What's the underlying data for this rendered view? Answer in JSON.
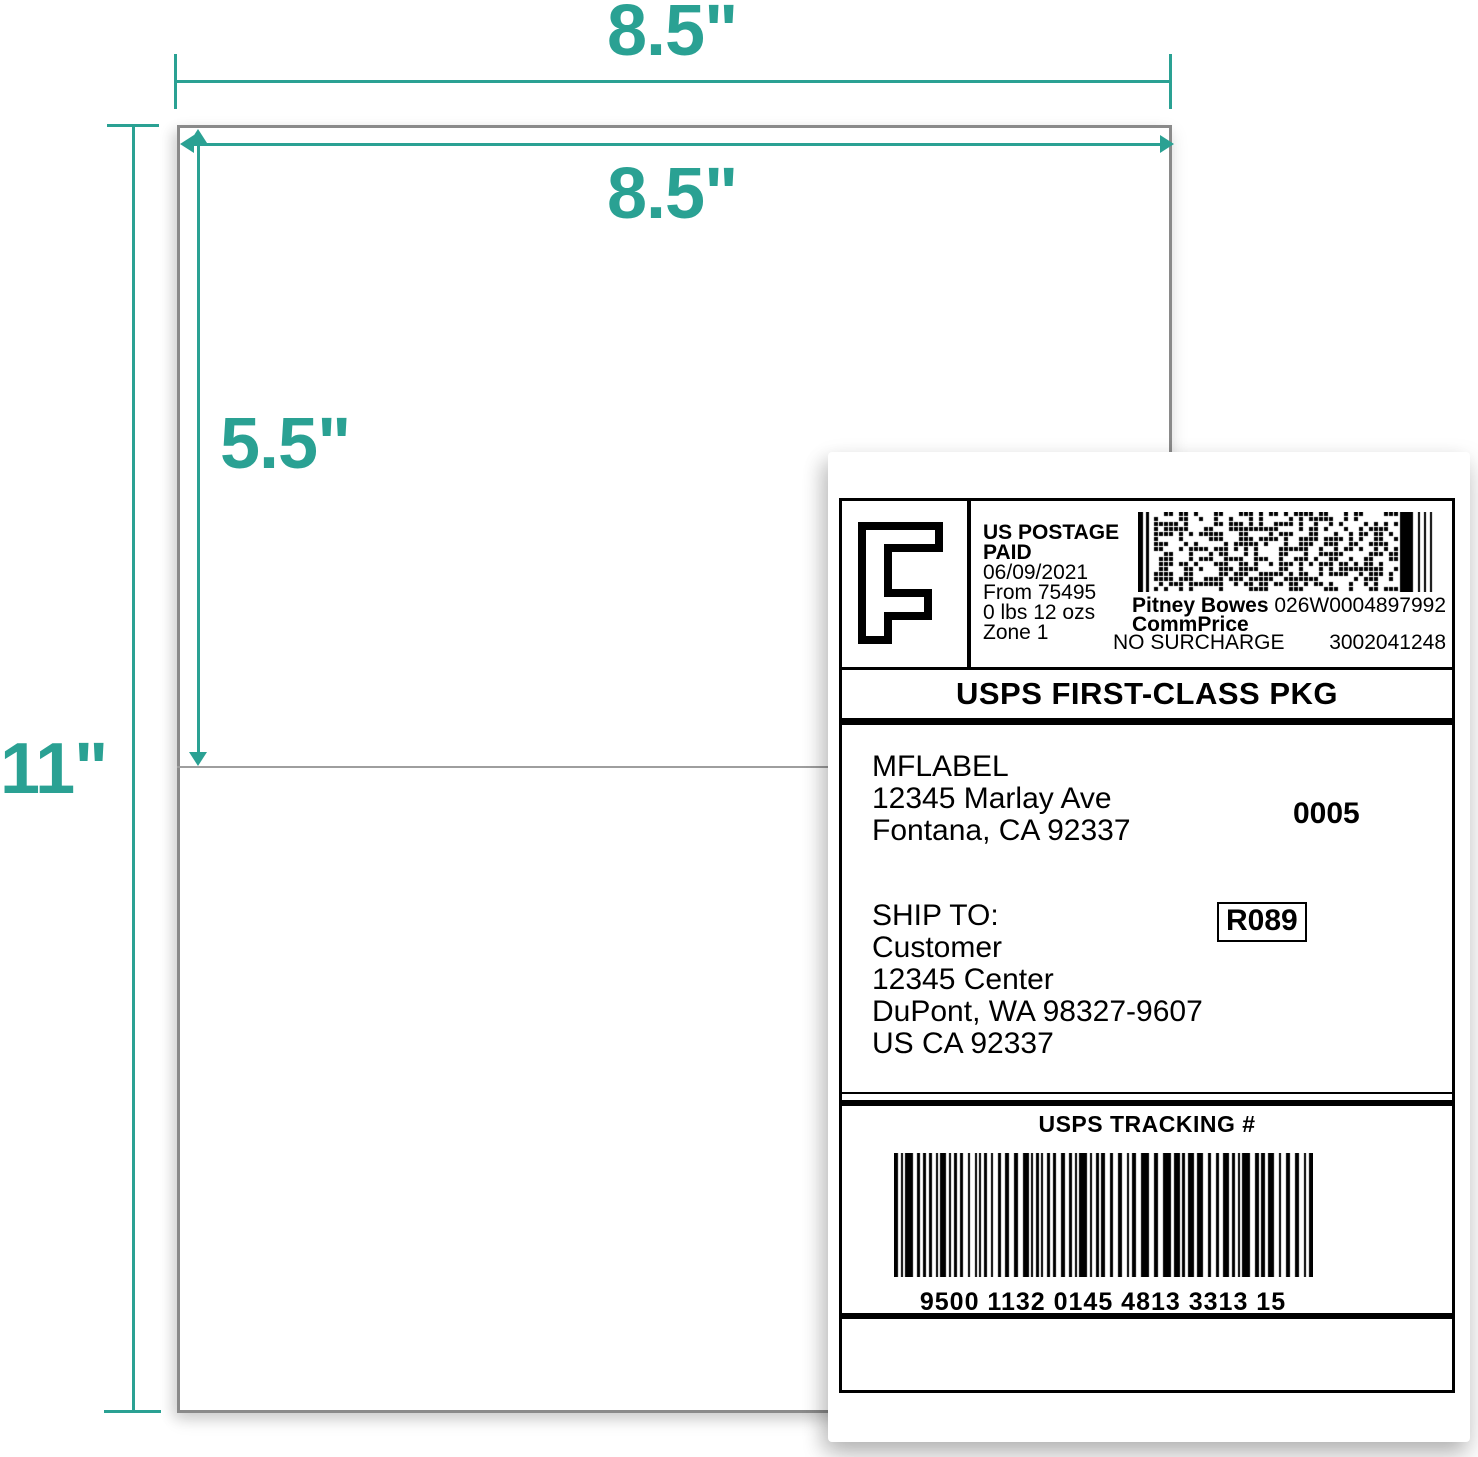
{
  "diagram": {
    "accent_color": "#2AA193",
    "sheet_width_top": "8.5\"",
    "sheet_width_inner": "8.5\"",
    "half_height": "5.5\"",
    "sheet_height": "11\""
  },
  "label": {
    "postage": {
      "indicia_letter": "F",
      "paid_line1": "US POSTAGE",
      "paid_line2": "PAID",
      "date": "06/09/2021",
      "origin": "From 75495",
      "weight": "0 lbs 12 ozs",
      "zone": "Zone 1",
      "carrier": "Pitney Bowes",
      "meter_code": "026W0004897992",
      "rate_name": "CommPrice",
      "surcharge": "NO SURCHARGE",
      "account_number": "3002041248"
    },
    "service_banner": "USPS FIRST-CLASS PKG",
    "sender": [
      "MFLABEL",
      "12345 Marlay Ave",
      "Fontana, CA 92337"
    ],
    "form_number": "0005",
    "ship_to_heading": "SHIP TO:",
    "recipient": [
      "Customer",
      "12345 Center",
      "DuPont, WA 98327-9607",
      "US CA 92337"
    ],
    "route_code": "R089",
    "tracking_heading": "USPS TRACKING #",
    "tracking_number": "9500 1132 0145 4813 3313 15"
  }
}
